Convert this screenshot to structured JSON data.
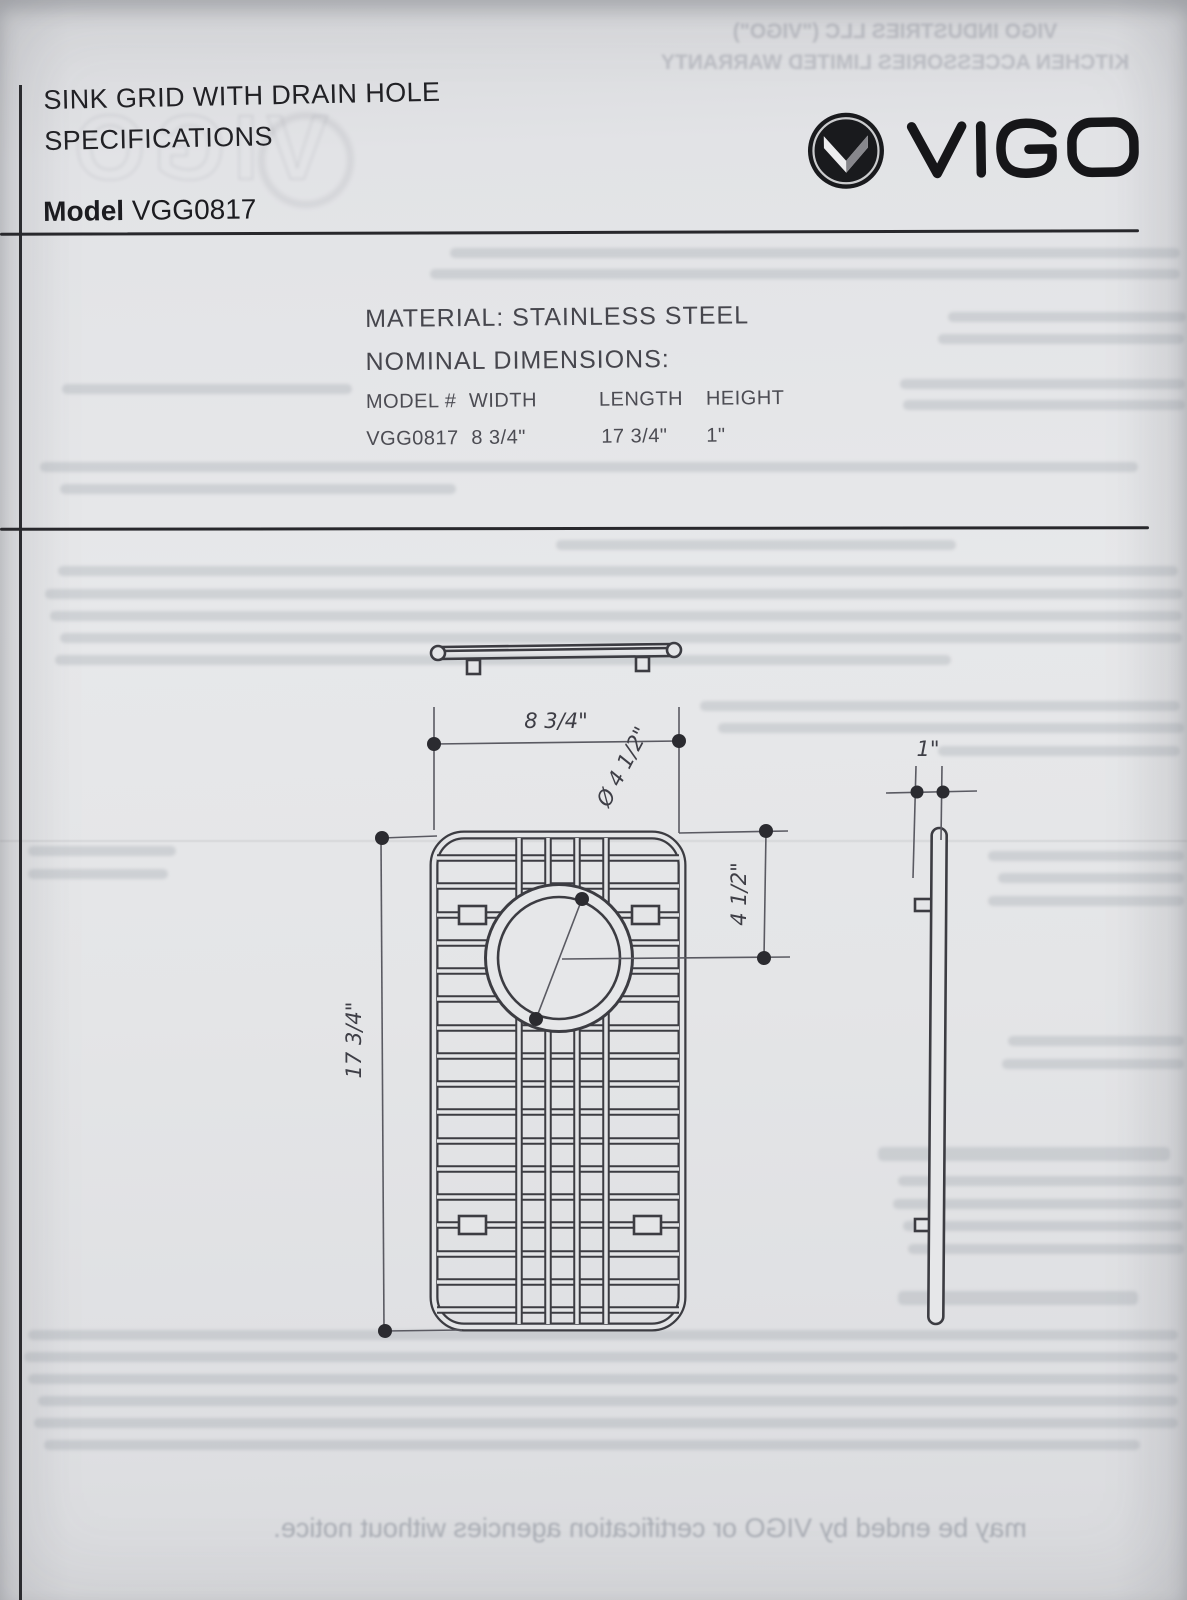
{
  "page": {
    "title_line1": "SINK GRID WITH DRAIN HOLE",
    "title_line2": "SPECIFICATIONS",
    "model_label": "Model",
    "model_value": "VGG0817"
  },
  "brand": {
    "logo_text": "VIGO",
    "logo_icon": "vigo-chevron-circle"
  },
  "specs": {
    "material": "MATERIAL: STAINLESS STEEL",
    "nominal": "NOMINAL DIMENSIONS:",
    "table": {
      "headers": [
        "MODEL #",
        "WIDTH",
        "LENGTH",
        "HEIGHT"
      ],
      "rows": [
        [
          "VGG0817",
          "8 3/4\"",
          "17 3/4\"",
          "1\""
        ]
      ]
    }
  },
  "drawing": {
    "dim_width": "8 3/4\"",
    "dim_diameter": "Ø 4 1/2\"",
    "dim_offset": "4 1/2\"",
    "dim_thickness": "1\"",
    "dim_length": "17 3/4\""
  },
  "bleed_through": {
    "top_line1": "VIGO INDUSTRIES LLC (\"VIGO\")",
    "top_line2": "KITCHEN ACCESSORIES LIMITED WARRANTY",
    "bottom_line": "may be ended by VIGO or certification agencies without notice.",
    "watermark": "VIGO"
  },
  "colors": {
    "paper": "#e4e5e7",
    "ink": "#1c1c20",
    "drawing_line": "#3c3c42",
    "bleed": "#7d828e"
  }
}
